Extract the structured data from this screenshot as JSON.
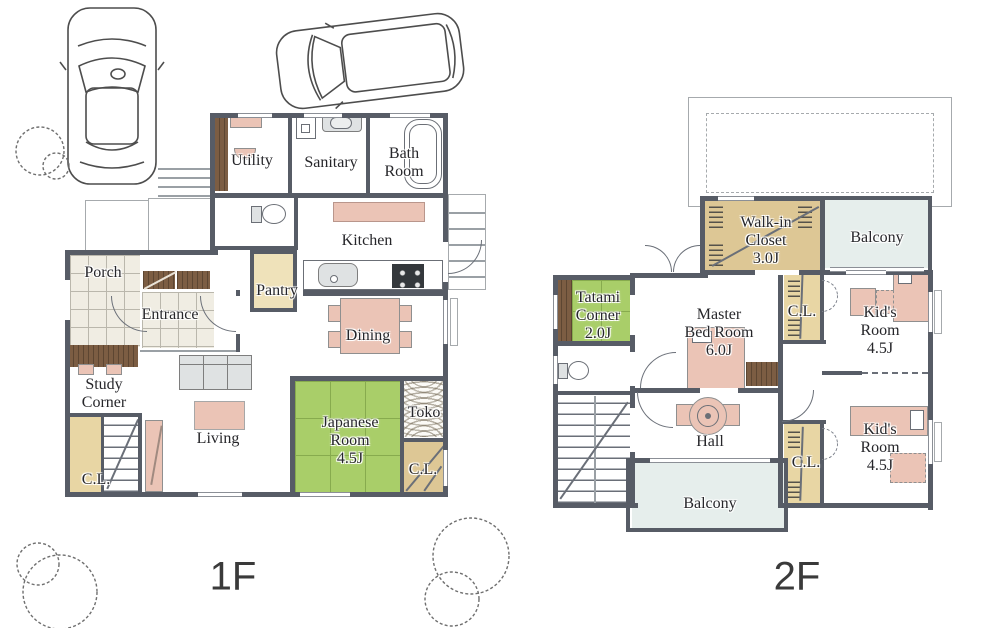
{
  "drawing": {
    "type": "house-floor-plan",
    "floor1": {
      "floor_label": "1F",
      "rooms": {
        "utility": "Utility",
        "sanitary": "Sanitary",
        "bath_room": "Bath\nRoom",
        "kitchen": "Kitchen",
        "porch": "Porch",
        "pantry": "Pantry",
        "entrance": "Entrance",
        "dining": "Dining",
        "study_corner": "Study\nCorner",
        "living": "Living",
        "japanese_room": "Japanese\nRoom\n4.5J",
        "toko": "Toko",
        "closet_left": "C.L.",
        "closet_right": "C.L."
      }
    },
    "floor2": {
      "floor_label": "2F",
      "rooms": {
        "walk_in_closet": "Walk-in\nCloset\n3.0J",
        "balcony_top": "Balcony",
        "tatami_corner": "Tatami\nCorner\n2.0J",
        "master_bed_room": "Master\nBed Room\n6.0J",
        "closet_upper": "C.L.",
        "kids_room_upper": "Kid's\nRoom\n4.5J",
        "hall": "Hall",
        "closet_lower": "C.L.",
        "kids_room_lower": "Kid's\nRoom\n4.5J",
        "balcony_bottom": "Balcony"
      }
    },
    "palette": {
      "wall": "#575c66",
      "tatami_green": "#a9ce69",
      "closet_tan": "#e8d6a4",
      "furniture_pink": "#ebc4b6",
      "balcony_blue": "#e6eeec",
      "wood_brown": "#7c5d43",
      "tile_beige": "#f0ede3"
    }
  }
}
